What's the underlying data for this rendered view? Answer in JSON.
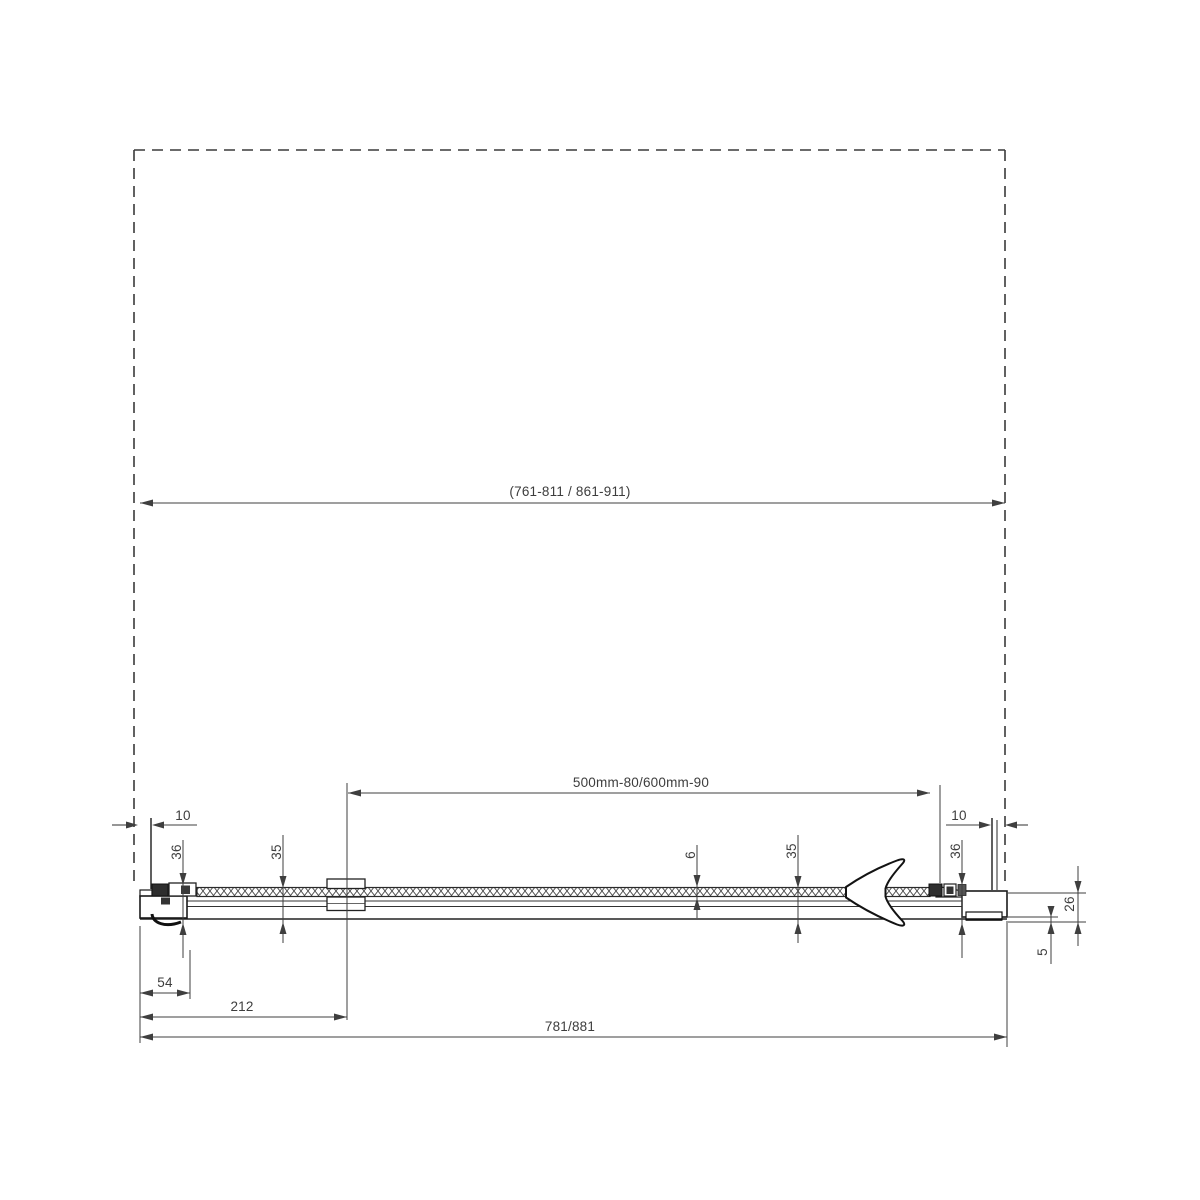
{
  "drawing": {
    "labels": {
      "overall_width": "(761-811 / 861-911)",
      "glass_panel_width": "500mm-80/600mm-90",
      "bottom_total_width": "781/881",
      "bottom_mid_width": "212",
      "bottom_left_width": "54",
      "left_gap": "10",
      "right_gap": "10",
      "left_profile_depth": "36",
      "right_profile_depth": "36",
      "left_door_depth": "35",
      "right_door_depth": "35",
      "glass_thickness": "6",
      "profile_height": "26",
      "bottom_step": "5"
    },
    "colors": {
      "background": "#ffffff",
      "dimension_line": "#3f3f3f",
      "profile_outline": "#1a1a1a",
      "text": "#3d3d3d"
    }
  }
}
